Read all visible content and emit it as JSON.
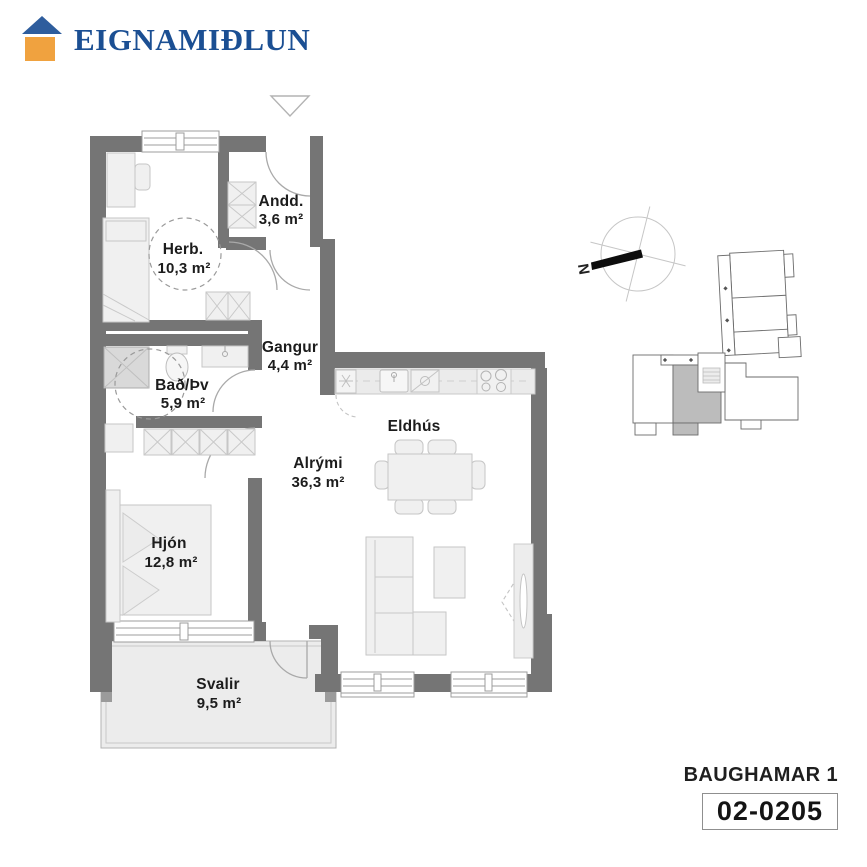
{
  "brand": {
    "name": "EIGNAMIÐLUN"
  },
  "rooms": {
    "herb": {
      "name": "Herb.",
      "area": "10,3 m²"
    },
    "andd": {
      "name": "Andd.",
      "area": "3,6 m²"
    },
    "gangur": {
      "name": "Gangur",
      "area": "4,4 m²"
    },
    "bad": {
      "name": "Bað/Þv",
      "area": "5,9 m²"
    },
    "alrymi": {
      "name": "Alrými",
      "area": "36,3 m²"
    },
    "eldhus": {
      "name": "Eldhús"
    },
    "hjon": {
      "name": "Hjón",
      "area": "12,8 m²"
    },
    "svalir": {
      "name": "Svalir",
      "area": "9,5 m²"
    }
  },
  "compass": {
    "north_label": "N"
  },
  "footer": {
    "building": "BAUGHAMAR 1",
    "unit_number": "02-0205"
  },
  "colors": {
    "wall": "#757575",
    "logo_roof": "#2e5d9d",
    "logo_body": "#f0a23f",
    "logo_text": "#1b4f93",
    "highlight_unit": "#bcbcbc"
  }
}
